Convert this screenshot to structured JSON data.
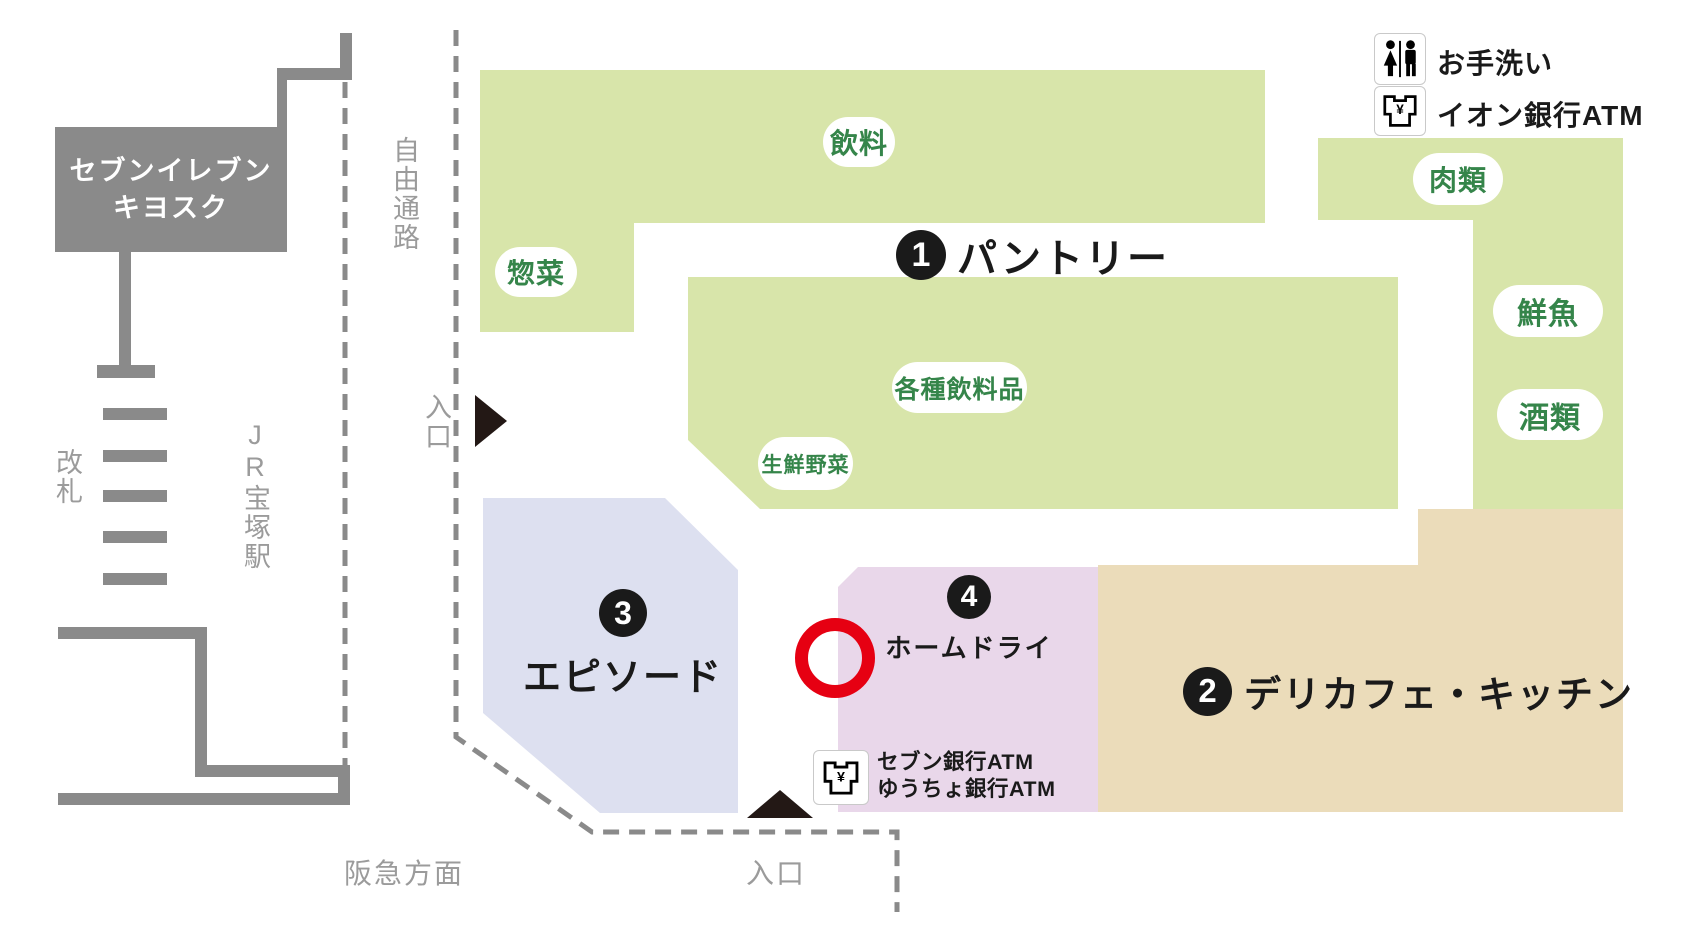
{
  "map_title": "宝塚駅前店 フロアマップ",
  "colors": {
    "department_green": "#d8e5aa",
    "episode_lavender": "#dde0f0",
    "home_dry_pink": "#e9d7ea",
    "delicafe_beige": "#ebdcba",
    "marker_red": "#e60012",
    "station_gray": "#8a8a8a",
    "label_gray": "#9b9b9b",
    "pill_text_green": "#35854a",
    "text_dark": "#1a1a1a"
  },
  "station": {
    "kiosk_line1": "セブンイレブン",
    "kiosk_line2": "キヨスク",
    "ticket_gate": "改札",
    "station_name": "JR宝塚駅",
    "hankyu_direction": "阪急方面",
    "free_passage": "自由通路"
  },
  "entrances": {
    "west": "入口",
    "south": "入口"
  },
  "legend": {
    "restroom": "お手洗い",
    "aeon_atm": "イオン銀行ATM"
  },
  "atm_corner": {
    "line1": "セブン銀行ATM",
    "line2": "ゆうちょ銀行ATM"
  },
  "areas": {
    "pantry": {
      "number": "1",
      "name": "パントリー"
    },
    "delicafe_kitchen": {
      "number": "2",
      "name": "デリカフェ・キッチン"
    },
    "episode": {
      "number": "3",
      "name": "エピソード"
    },
    "home_dry": {
      "number": "4",
      "name": "ホームドライ"
    }
  },
  "departments": {
    "drinks": "飲料",
    "deli": "惣菜",
    "various_beverages": "各種飲料品",
    "fresh_vegetables": "生鮮野菜",
    "meat": "肉類",
    "fresh_fish": "鮮魚",
    "liquor": "酒類"
  }
}
